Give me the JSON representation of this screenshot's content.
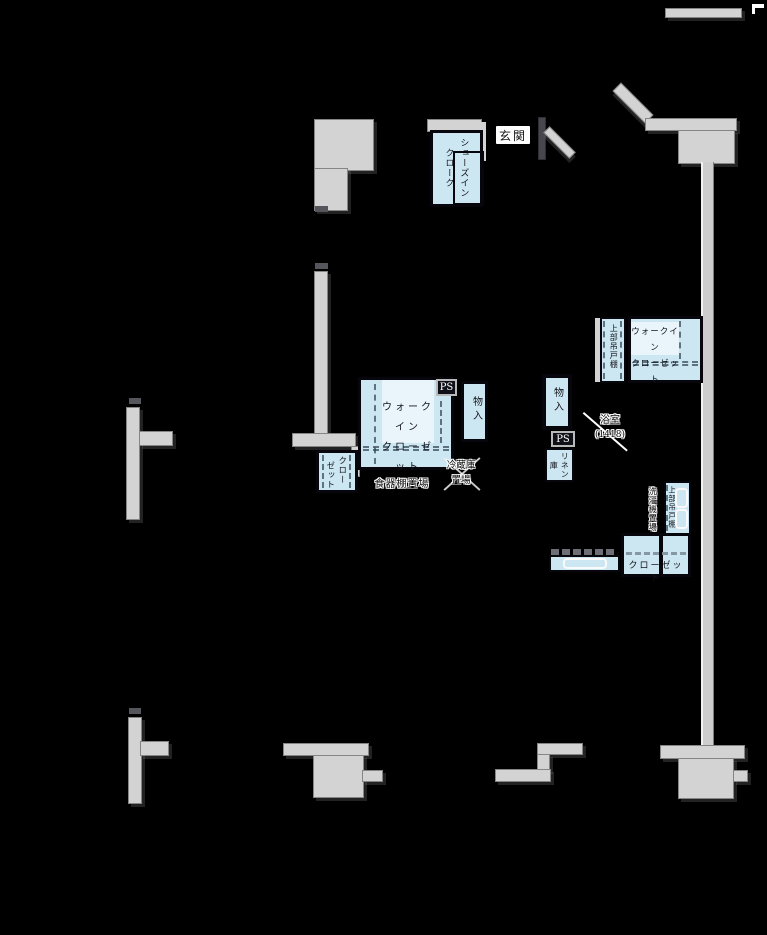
{
  "floorplan": {
    "entrance": {
      "label": "玄関"
    },
    "shoes_in_closet": {
      "label_columns": [
        "シューズイン",
        "クローク"
      ]
    },
    "walk_in_closet_center": {
      "label_lines": [
        "ウォークイン",
        "クローゼット"
      ]
    },
    "pipe_space_left": {
      "label": "PS"
    },
    "storage_center": {
      "label": "物入"
    },
    "storage_right": {
      "label": "物入"
    },
    "pipe_space_right": {
      "label": "PS"
    },
    "linen_storage": {
      "label_columns": [
        "リネン",
        "庫"
      ]
    },
    "walk_in_closet_right": {
      "label_lines": [
        "ウォークイン",
        "クローゼット"
      ],
      "upper_cabinet_label": "上部吊戸棚"
    },
    "kitchen": {
      "cupboard_space_label": "食器棚置場",
      "fridge_space_lines": [
        "冷蔵庫",
        "置場"
      ]
    },
    "bathroom": {
      "label_lines": [
        "浴室",
        "(1418)"
      ]
    },
    "laundry": {
      "washer_space_label": "洗濯機置場",
      "upper_cabinet_label": "上部吊戸棚"
    },
    "closet_left": {
      "label_columns": [
        "クロー",
        "ゼット"
      ]
    },
    "closet_bottom_right": {
      "label": "クローゼット"
    }
  },
  "colors": {
    "background": "#000000",
    "wall": "#d3d3d3",
    "closet_fill": "#cde7f2",
    "closet_label_fill": "#e9f5fb",
    "outline": "#06060c",
    "halo_text": "#0a0a0a"
  }
}
